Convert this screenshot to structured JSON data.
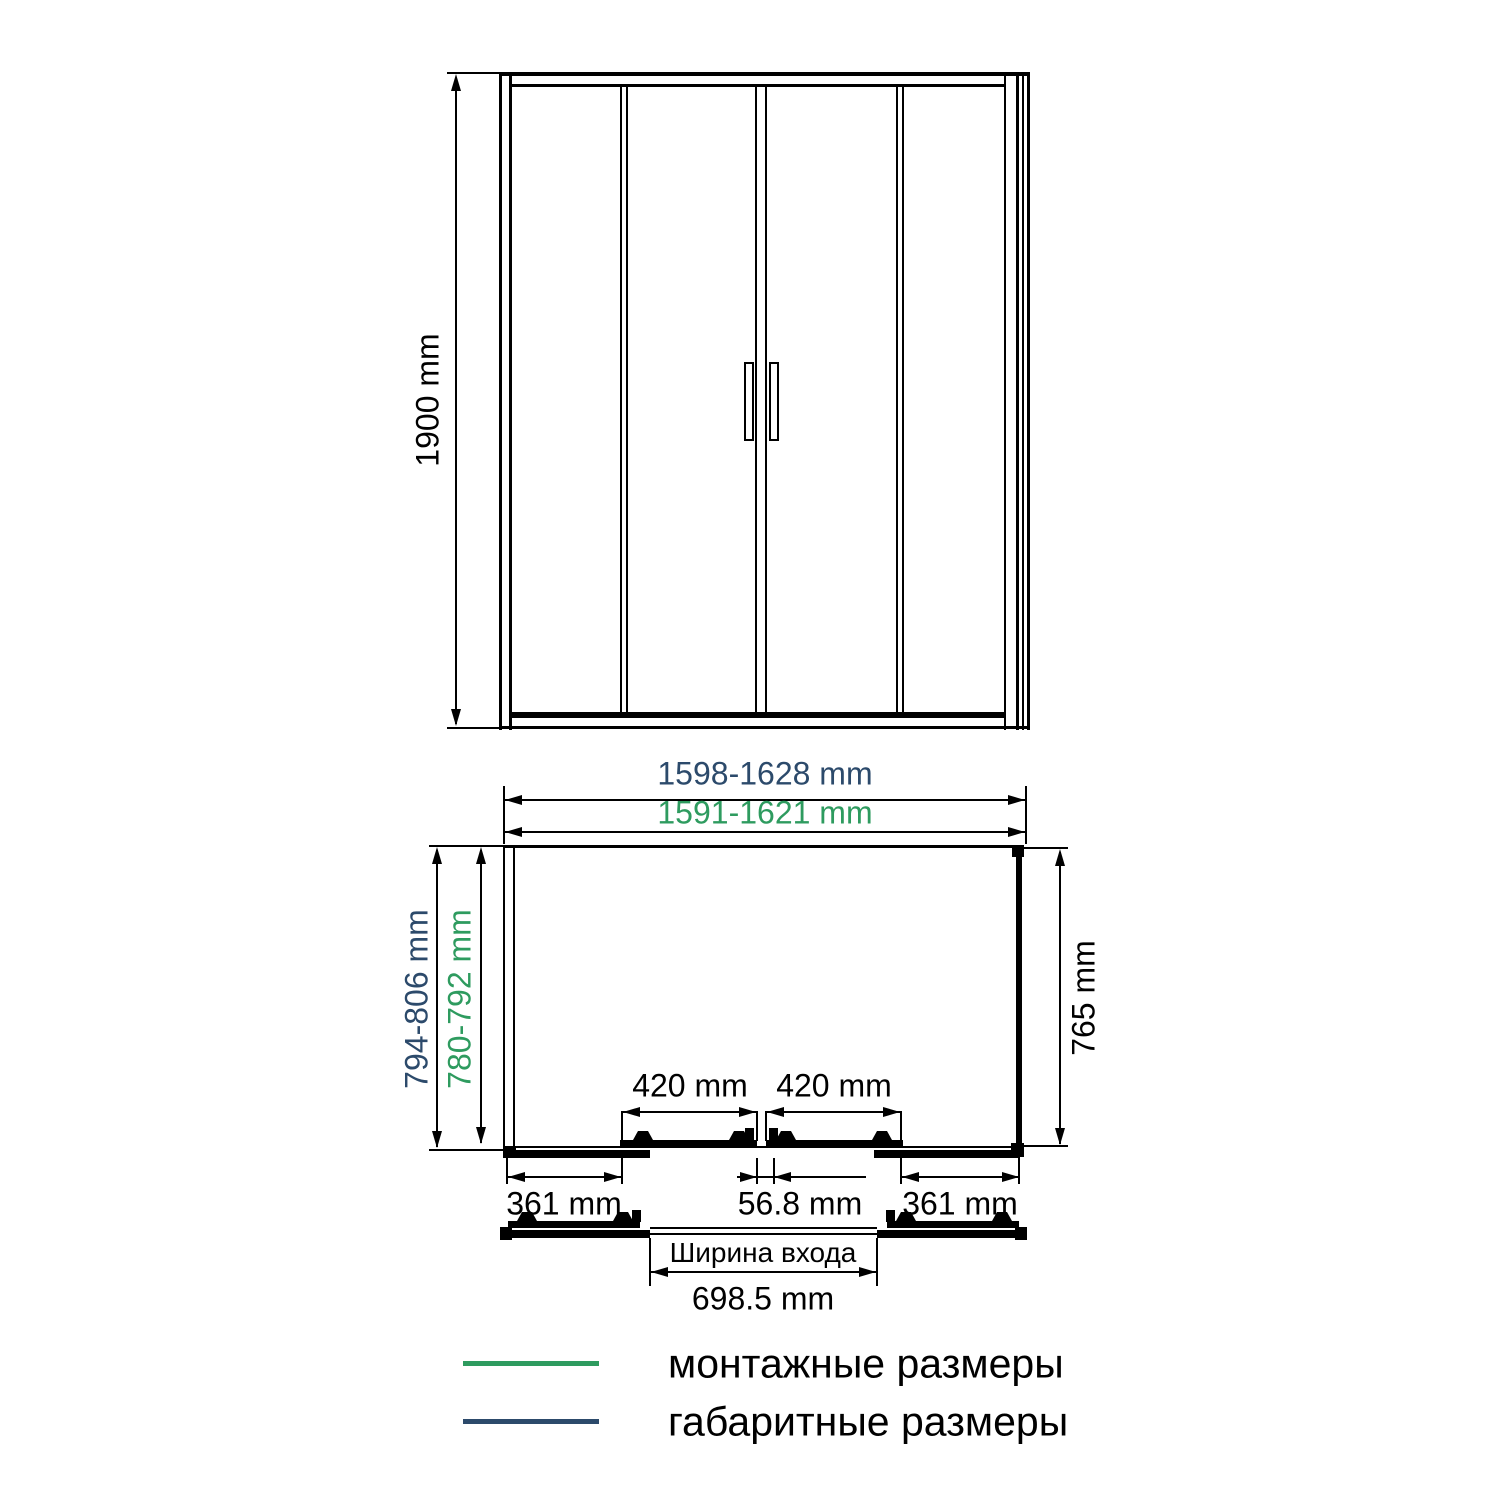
{
  "diagram": {
    "front_view": {
      "height_label": "1900 mm"
    },
    "plan_view": {
      "overall_width_label": "1598-1628 mm",
      "install_width_label": "1591-1621 mm",
      "overall_depth_label": "794-806 mm",
      "install_depth_label": "780-792 mm",
      "side_depth_label": "765 mm",
      "door_left_label": "420 mm",
      "door_right_label": "420 mm",
      "fixed_left_label": "361 mm",
      "center_overlap_label": "56.8 mm",
      "fixed_right_label": "361 mm"
    },
    "entrance": {
      "title": "Ширина входа",
      "width_label": "698.5 mm"
    },
    "legend": [
      {
        "label": "монтажные размеры",
        "color": "#2e9b5f"
      },
      {
        "label": "габаритные размеры",
        "color": "#2c4a6b"
      }
    ],
    "colors": {
      "installation": "#2e9b5f",
      "overall": "#2c4a6b",
      "line": "#000000"
    }
  }
}
